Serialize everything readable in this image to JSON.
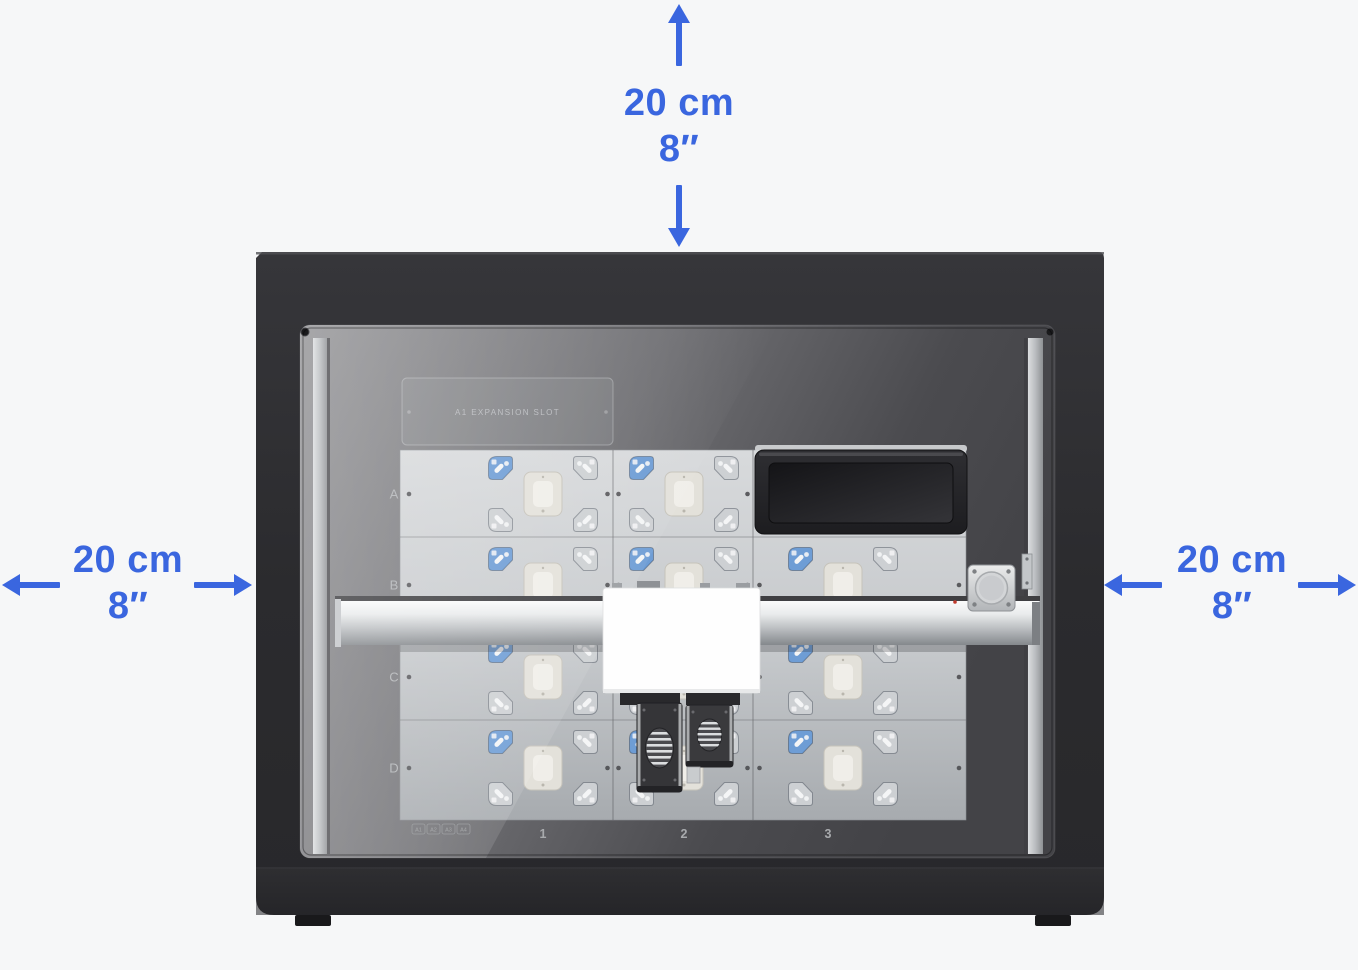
{
  "colors": {
    "accent": "#3a66df",
    "bracket_blue": "#6e9dd5",
    "bracket_gray": "#cdd0d3"
  },
  "clearances": {
    "top": {
      "metric": "20 cm",
      "imperial": "8″"
    },
    "left": {
      "metric": "20 cm",
      "imperial": "8″"
    },
    "right": {
      "metric": "20 cm",
      "imperial": "8″"
    }
  },
  "machine": {
    "deck": {
      "row_labels": [
        "A",
        "B",
        "C",
        "D"
      ],
      "column_labels": [
        "1",
        "2",
        "3"
      ],
      "expansion_slot_label": "A1 EXPANSION SLOT",
      "corner_tags": [
        "A1",
        "A2",
        "A3",
        "A4"
      ]
    }
  }
}
